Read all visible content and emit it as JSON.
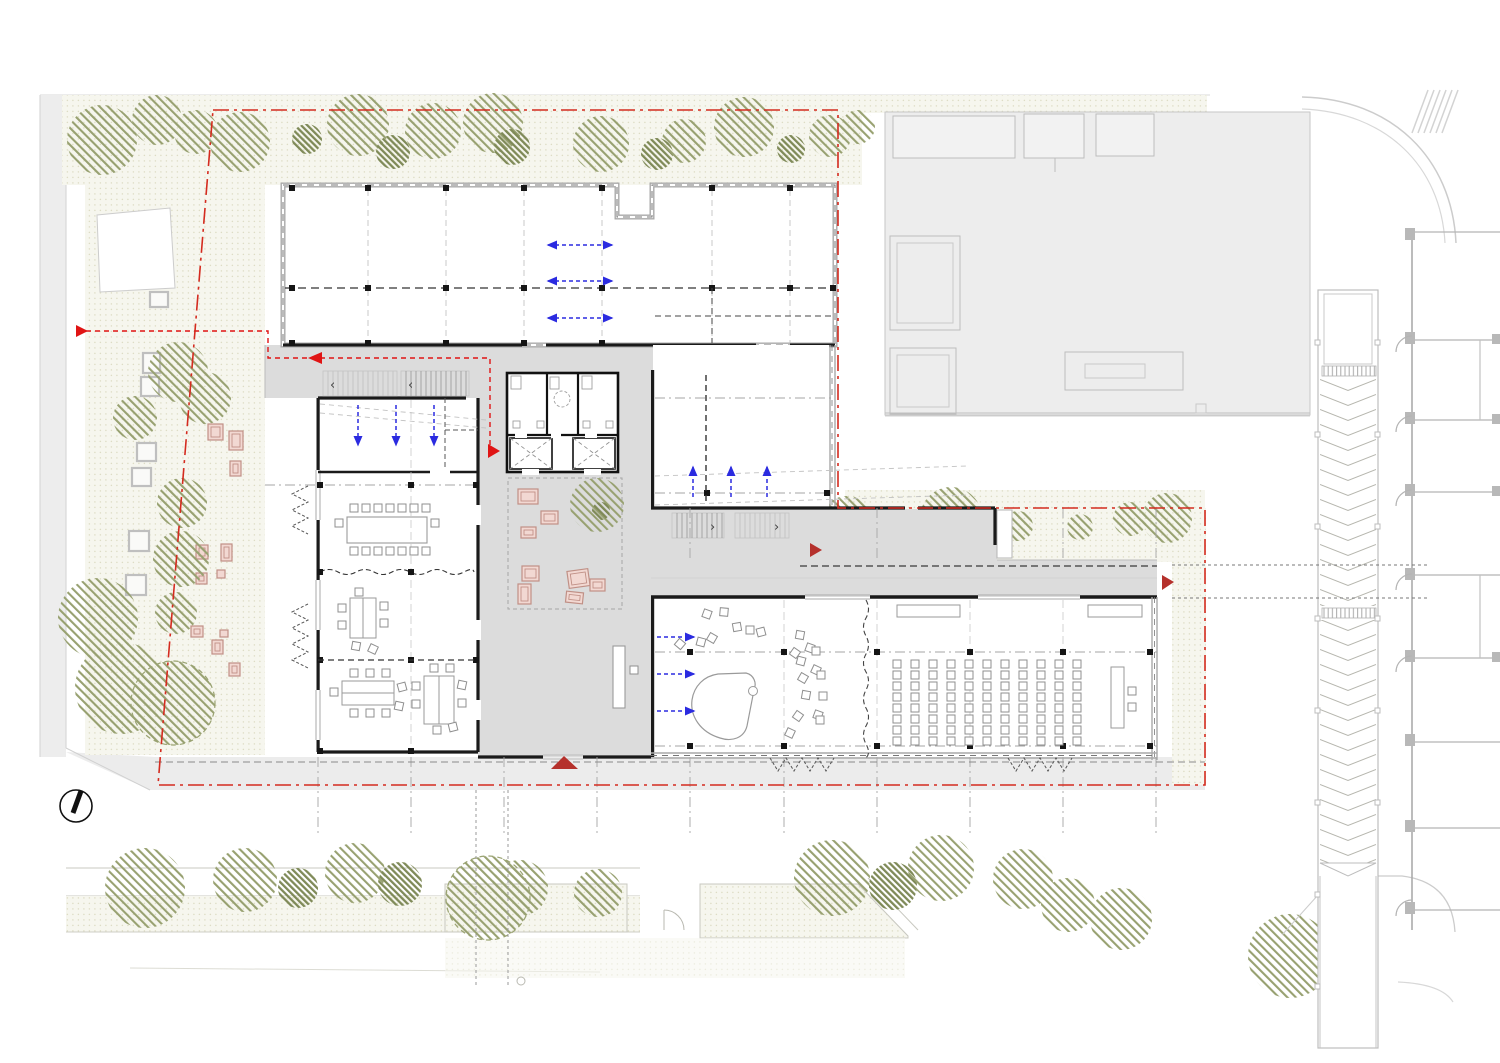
{
  "title": "ground-floor-site-plan",
  "colors": {
    "background": "#ffffff",
    "paving": "#ececec",
    "floor_gray": "#dcdcdc",
    "wall_black": "#1a1a1a",
    "curtain_gray": "#a9a9a9",
    "garden_base": "#f6f6ee",
    "garden_dot": "#dddcc4",
    "tree_hatch": "#98a171",
    "tree_hatch_dark": "#7f8a58",
    "furniture_pink_fill": "#f2d8d2",
    "furniture_pink_stroke": "#c09086",
    "boundary_red": "#d42b1f",
    "route_red": "#e01414",
    "entrance_red": "#b5312c",
    "airflow_blue": "#2b2be0",
    "grid_gray": "#a6a6a6",
    "seat_stroke": "#8f8f8f"
  },
  "boundary": {
    "path": "M213,110 H838 V508 H1205 V785 H158 Z"
  },
  "route": {
    "points": "86,331 268,331 268,358 490,358 490,449",
    "arrows": [
      "76,325 76,337 88,331",
      "322,352 322,364 308,358",
      "488,444 488,458 500,451"
    ]
  },
  "entrance_markers": [
    "551,769 578,769 564,756",
    "810,543 810,557 822,550",
    "1162,575 1162,590 1174,582"
  ],
  "vegetation": {
    "trees": [
      [
        102,
        140,
        35,
        0
      ],
      [
        157,
        120,
        25,
        0
      ],
      [
        196,
        132,
        22,
        0
      ],
      [
        240,
        142,
        30,
        0
      ],
      [
        307,
        139,
        15,
        1
      ],
      [
        358,
        125,
        31,
        0
      ],
      [
        393,
        152,
        17,
        1
      ],
      [
        433,
        131,
        28,
        0
      ],
      [
        493,
        123,
        30,
        0
      ],
      [
        512,
        147,
        18,
        1
      ],
      [
        601,
        144,
        28,
        0
      ],
      [
        657,
        154,
        16,
        1
      ],
      [
        684,
        141,
        22,
        0
      ],
      [
        744,
        127,
        30,
        0
      ],
      [
        791,
        149,
        14,
        1
      ],
      [
        830,
        136,
        21,
        0
      ],
      [
        858,
        127,
        17,
        0
      ],
      [
        135,
        418,
        22,
        0
      ],
      [
        178,
        372,
        30,
        0
      ],
      [
        205,
        398,
        26,
        0
      ],
      [
        182,
        503,
        25,
        0
      ],
      [
        181,
        559,
        28,
        0
      ],
      [
        176,
        613,
        21,
        0
      ],
      [
        98,
        618,
        40,
        0
      ],
      [
        121,
        688,
        46,
        0
      ],
      [
        173,
        703,
        42,
        2
      ],
      [
        847,
        522,
        26,
        0
      ],
      [
        920,
        530,
        14,
        1
      ],
      [
        951,
        518,
        31,
        0
      ],
      [
        1018,
        526,
        15,
        0
      ],
      [
        1080,
        527,
        13,
        0
      ],
      [
        1130,
        519,
        17,
        0
      ],
      [
        1167,
        518,
        25,
        0
      ],
      [
        145,
        888,
        40,
        0
      ],
      [
        245,
        880,
        32,
        0
      ],
      [
        298,
        888,
        20,
        1
      ],
      [
        355,
        873,
        30,
        0
      ],
      [
        400,
        884,
        22,
        1
      ],
      [
        520,
        888,
        28,
        0
      ],
      [
        598,
        893,
        24,
        0
      ],
      [
        488,
        898,
        42,
        2
      ],
      [
        832,
        878,
        38,
        0
      ],
      [
        893,
        886,
        24,
        1
      ],
      [
        941,
        868,
        33,
        0
      ],
      [
        1023,
        879,
        30,
        0
      ],
      [
        1068,
        905,
        27,
        0
      ],
      [
        1121,
        919,
        31,
        0
      ],
      [
        1290,
        956,
        42,
        0
      ]
    ],
    "trees_top": [
      [
        597,
        505,
        27,
        0
      ],
      [
        601,
        511,
        9,
        1
      ]
    ]
  },
  "planters": [
    [
      150,
      292,
      18,
      15
    ],
    [
      143,
      353,
      17,
      20
    ],
    [
      141,
      377,
      18,
      19
    ],
    [
      137,
      443,
      19,
      18
    ],
    [
      132,
      468,
      19,
      18
    ],
    [
      129,
      531,
      20,
      20
    ],
    [
      126,
      575,
      20,
      20
    ]
  ],
  "garden_furniture": [
    [
      208,
      424,
      15,
      16,
      0
    ],
    [
      229,
      431,
      14,
      19,
      0
    ],
    [
      230,
      461,
      11,
      15,
      0
    ],
    [
      196,
      545,
      12,
      14,
      0
    ],
    [
      221,
      544,
      11,
      17,
      0
    ],
    [
      217,
      570,
      8,
      8,
      0
    ],
    [
      196,
      573,
      11,
      11,
      0
    ],
    [
      191,
      626,
      12,
      11,
      0
    ],
    [
      212,
      640,
      11,
      14,
      0
    ],
    [
      220,
      630,
      8,
      7,
      0
    ],
    [
      229,
      663,
      11,
      13,
      0
    ]
  ],
  "lobby_furniture": [
    [
      518,
      489,
      20,
      15,
      0
    ],
    [
      541,
      511,
      17,
      13,
      0
    ],
    [
      521,
      527,
      15,
      11,
      0
    ],
    [
      522,
      566,
      17,
      15,
      0
    ],
    [
      518,
      584,
      13,
      20,
      0
    ],
    [
      568,
      570,
      21,
      17,
      -8
    ],
    [
      590,
      579,
      15,
      12,
      0
    ],
    [
      566,
      592,
      17,
      11,
      6
    ]
  ],
  "auditorium": {
    "x0": 893,
    "y0": 660,
    "cols_left": 5,
    "aisle_x": 983,
    "cols_right": 6,
    "dx": 18,
    "dy": 11,
    "rows": 8,
    "seat": 8
  },
  "music_chairs": [
    [
      703,
      610,
      20
    ],
    [
      720,
      608,
      5
    ],
    [
      733,
      623,
      -10
    ],
    [
      746,
      626,
      0
    ],
    [
      757,
      628,
      -15
    ],
    [
      708,
      634,
      30
    ],
    [
      697,
      638,
      15
    ],
    [
      676,
      640,
      40
    ],
    [
      796,
      631,
      10
    ],
    [
      806,
      644,
      20
    ],
    [
      812,
      647,
      0
    ],
    [
      791,
      649,
      35
    ],
    [
      797,
      657,
      15
    ],
    [
      812,
      666,
      25
    ],
    [
      817,
      671,
      0
    ],
    [
      799,
      674,
      30
    ],
    [
      802,
      691,
      10
    ],
    [
      819,
      692,
      0
    ],
    [
      814,
      711,
      20
    ],
    [
      794,
      712,
      35
    ],
    [
      816,
      716,
      0
    ],
    [
      786,
      729,
      25
    ]
  ],
  "small_chairs": [
    [
      350,
      504,
      0
    ],
    [
      362,
      504,
      0
    ],
    [
      374,
      504,
      0
    ],
    [
      386,
      504,
      0
    ],
    [
      398,
      504,
      0
    ],
    [
      410,
      504,
      0
    ],
    [
      422,
      504,
      0
    ],
    [
      350,
      547,
      0
    ],
    [
      362,
      547,
      0
    ],
    [
      374,
      547,
      0
    ],
    [
      386,
      547,
      0
    ],
    [
      398,
      547,
      0
    ],
    [
      410,
      547,
      0
    ],
    [
      422,
      547,
      0
    ],
    [
      335,
      519,
      0
    ],
    [
      431,
      519,
      0
    ],
    [
      338,
      604,
      0
    ],
    [
      338,
      621,
      0
    ],
    [
      380,
      602,
      0
    ],
    [
      380,
      619,
      0
    ],
    [
      355,
      588,
      0
    ],
    [
      352,
      642,
      10
    ],
    [
      369,
      645,
      25
    ],
    [
      350,
      669,
      0
    ],
    [
      366,
      669,
      0
    ],
    [
      382,
      669,
      0
    ],
    [
      350,
      709,
      0
    ],
    [
      366,
      709,
      0
    ],
    [
      382,
      709,
      0
    ],
    [
      330,
      688,
      0
    ],
    [
      398,
      683,
      -15
    ],
    [
      395,
      702,
      12
    ],
    [
      412,
      682,
      0
    ],
    [
      412,
      700,
      0
    ],
    [
      458,
      681,
      12
    ],
    [
      458,
      699,
      0
    ],
    [
      430,
      664,
      0
    ],
    [
      446,
      664,
      0
    ],
    [
      433,
      726,
      0
    ],
    [
      449,
      723,
      -14
    ],
    [
      1128,
      687,
      0
    ],
    [
      1128,
      703,
      0
    ],
    [
      630,
      666,
      0
    ]
  ],
  "blue_arrows": [
    [
      548,
      245,
      612,
      245,
      2
    ],
    [
      548,
      281,
      612,
      281,
      2
    ],
    [
      548,
      318,
      612,
      318,
      2
    ],
    [
      358,
      405,
      358,
      445,
      1
    ],
    [
      396,
      405,
      396,
      445,
      1
    ],
    [
      434,
      405,
      434,
      445,
      1
    ],
    [
      693,
      497,
      693,
      467,
      1
    ],
    [
      731,
      497,
      731,
      467,
      1
    ],
    [
      767,
      497,
      767,
      467,
      1
    ],
    [
      657,
      637,
      694,
      637,
      1
    ],
    [
      657,
      674,
      694,
      674,
      1
    ],
    [
      657,
      711,
      694,
      711,
      1
    ]
  ],
  "stairs": [
    {
      "x": 323,
      "y": 371,
      "w": 74,
      "h": 25,
      "step": 5,
      "tone": "light"
    },
    {
      "x": 401,
      "y": 371,
      "w": 68,
      "h": 25,
      "step": 5,
      "tone": "mid"
    },
    {
      "x": 672,
      "y": 513,
      "w": 52,
      "h": 25,
      "step": 5,
      "tone": "mid"
    },
    {
      "x": 735,
      "y": 513,
      "w": 54,
      "h": 25,
      "step": 5,
      "tone": "light"
    }
  ],
  "stair_arrows": [
    {
      "x": 330,
      "y": 389,
      "ch": "‹"
    },
    {
      "x": 408,
      "y": 389,
      "ch": "‹"
    },
    {
      "x": 710,
      "y": 531,
      "ch": "›"
    },
    {
      "x": 774,
      "y": 531,
      "ch": "›"
    }
  ],
  "grid_lines": [
    [
      368,
      190,
      368,
      343,
      "d"
    ],
    [
      446,
      190,
      446,
      343,
      "d"
    ],
    [
      524,
      190,
      524,
      343,
      "d"
    ],
    [
      602,
      190,
      602,
      343,
      "d"
    ],
    [
      712,
      190,
      712,
      343,
      "d"
    ],
    [
      790,
      190,
      790,
      343,
      "d"
    ],
    [
      285,
      288,
      833,
      288,
      "bd"
    ],
    [
      265,
      485,
      478,
      485,
      "dd"
    ],
    [
      655,
      652,
      1157,
      652,
      "dd"
    ],
    [
      655,
      746,
      1157,
      746,
      "dd"
    ],
    [
      655,
      398,
      835,
      398,
      "dd"
    ],
    [
      655,
      493,
      835,
      493,
      "dd"
    ],
    [
      318,
      757,
      318,
      833,
      "dd"
    ],
    [
      411,
      757,
      411,
      833,
      "dd"
    ],
    [
      504,
      757,
      504,
      833,
      "dd"
    ],
    [
      597,
      757,
      597,
      833,
      "dd"
    ],
    [
      690,
      757,
      690,
      833,
      "dd"
    ],
    [
      784,
      757,
      784,
      833,
      "dd"
    ],
    [
      877,
      757,
      877,
      833,
      "dd"
    ],
    [
      970,
      757,
      970,
      833,
      "dd"
    ],
    [
      1063,
      757,
      1063,
      833,
      "dd"
    ],
    [
      1156,
      757,
      1156,
      833,
      "dd"
    ],
    [
      690,
      508,
      690,
      560,
      "dd"
    ],
    [
      877,
      508,
      877,
      560,
      "dd"
    ],
    [
      1063,
      508,
      1063,
      560,
      "dd"
    ],
    [
      1156,
      508,
      1156,
      560,
      "dd"
    ],
    [
      784,
      600,
      784,
      746,
      "f"
    ],
    [
      877,
      600,
      877,
      746,
      "f"
    ],
    [
      970,
      600,
      970,
      746,
      "f"
    ],
    [
      1063,
      600,
      1063,
      746,
      "f"
    ],
    [
      411,
      400,
      411,
      750,
      "f"
    ]
  ],
  "columns": [
    [
      292,
      188
    ],
    [
      368,
      188
    ],
    [
      446,
      188
    ],
    [
      524,
      188
    ],
    [
      602,
      188
    ],
    [
      712,
      188
    ],
    [
      790,
      188
    ],
    [
      292,
      288
    ],
    [
      368,
      288
    ],
    [
      446,
      288
    ],
    [
      524,
      288
    ],
    [
      602,
      288
    ],
    [
      712,
      288
    ],
    [
      790,
      288
    ],
    [
      833,
      288
    ],
    [
      292,
      343
    ],
    [
      368,
      343
    ],
    [
      446,
      343
    ],
    [
      524,
      343
    ],
    [
      602,
      343
    ],
    [
      707,
      493
    ],
    [
      827,
      493
    ],
    [
      320,
      485
    ],
    [
      411,
      485
    ],
    [
      476,
      485
    ],
    [
      320,
      572
    ],
    [
      411,
      572
    ],
    [
      320,
      660
    ],
    [
      411,
      660
    ],
    [
      476,
      660
    ],
    [
      320,
      751
    ],
    [
      411,
      751
    ],
    [
      690,
      652
    ],
    [
      784,
      652
    ],
    [
      877,
      652
    ],
    [
      970,
      652
    ],
    [
      1063,
      652
    ],
    [
      1150,
      652
    ],
    [
      690,
      746
    ],
    [
      784,
      746
    ],
    [
      877,
      746
    ],
    [
      970,
      746
    ],
    [
      1063,
      746
    ],
    [
      1150,
      746
    ]
  ],
  "dashed_lines": [
    [
      155,
      762,
      1205,
      762,
      "7,4",
      "#8a8a8a",
      1
    ],
    [
      800,
      566,
      1157,
      566,
      "7,4",
      "#3a3a3a",
      1.3
    ],
    [
      476,
      790,
      476,
      985,
      "3,3",
      "#9a9a9a",
      1
    ],
    [
      508,
      790,
      508,
      985,
      "3,3",
      "#9a9a9a",
      1
    ],
    [
      1172,
      565,
      1428,
      565,
      "3,3",
      "#777777",
      1.1
    ],
    [
      1172,
      598,
      1428,
      598,
      "3,3",
      "#777777",
      1.1
    ],
    [
      655,
      476,
      968,
      466,
      "5,4",
      "#c2c2c2",
      0.9
    ],
    [
      655,
      505,
      968,
      495,
      "5,4",
      "#c2c2c2",
      0.9
    ],
    [
      320,
      404,
      486,
      420,
      "5,4",
      "#c2c2c2",
      0.9
    ],
    [
      320,
      413,
      486,
      428,
      "5,4",
      "#c2c2c2",
      0.9
    ],
    [
      706,
      375,
      706,
      505,
      "6,4",
      "#333333",
      1.4
    ],
    [
      712,
      288,
      712,
      343,
      "6,4",
      "#444444",
      1
    ],
    [
      655,
      316,
      833,
      316,
      "6,4",
      "#444444",
      1
    ],
    [
      445,
      398,
      445,
      470,
      "5,3",
      "#555555",
      1
    ],
    [
      445,
      430,
      478,
      430,
      "5,3",
      "#555555",
      1
    ],
    [
      318,
      660,
      478,
      660,
      "6,4",
      "#333333",
      1.2
    ]
  ],
  "vent_chevrons": [
    "M308,486 l-16,8 l16,8 l-16,8 l16,8 l-16,8 l16,8",
    "M308,604 l-16,8 l16,8 l-16,8 l16,8 l-16,8 l16,8 l-16,8 l16,8",
    "M770,758 l8,13 l8,-13 l8,13 l8,-13 l8,13 l8,-13 l8,13 l8,-13",
    "M1008,758 l8,13 l8,-13 l8,13 l8,-13 l8,13 l8,-13 l8,13 l8,-13"
  ]
}
